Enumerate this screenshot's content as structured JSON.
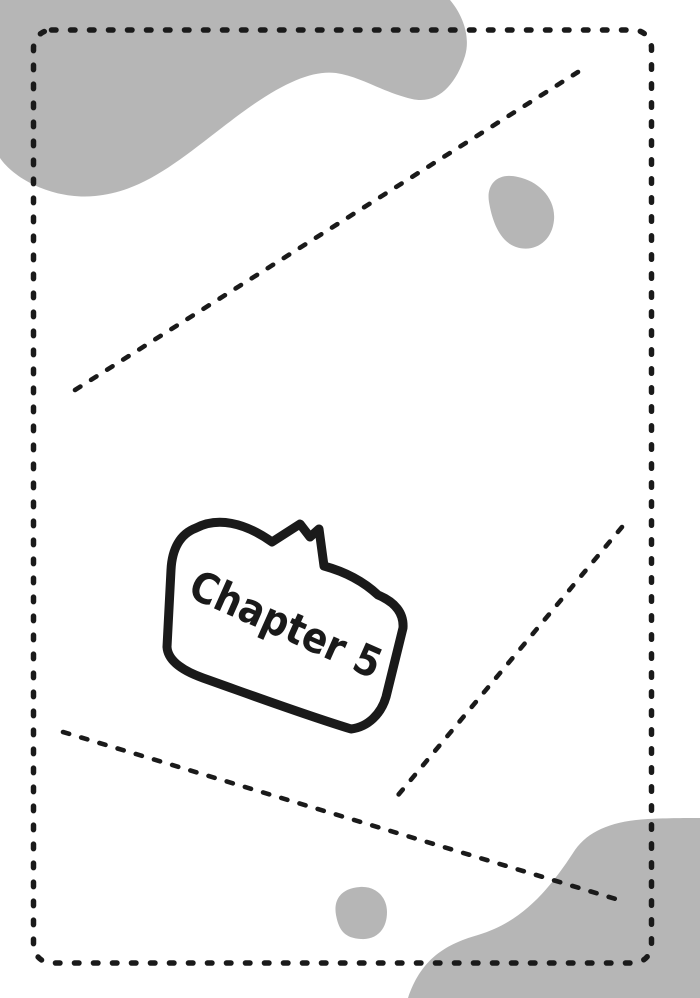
{
  "bubble": {
    "label": "Chapter 5"
  },
  "colors": {
    "background": "#ffffff",
    "ink": "#1a1a1a",
    "blob": "#b6b6b6"
  }
}
